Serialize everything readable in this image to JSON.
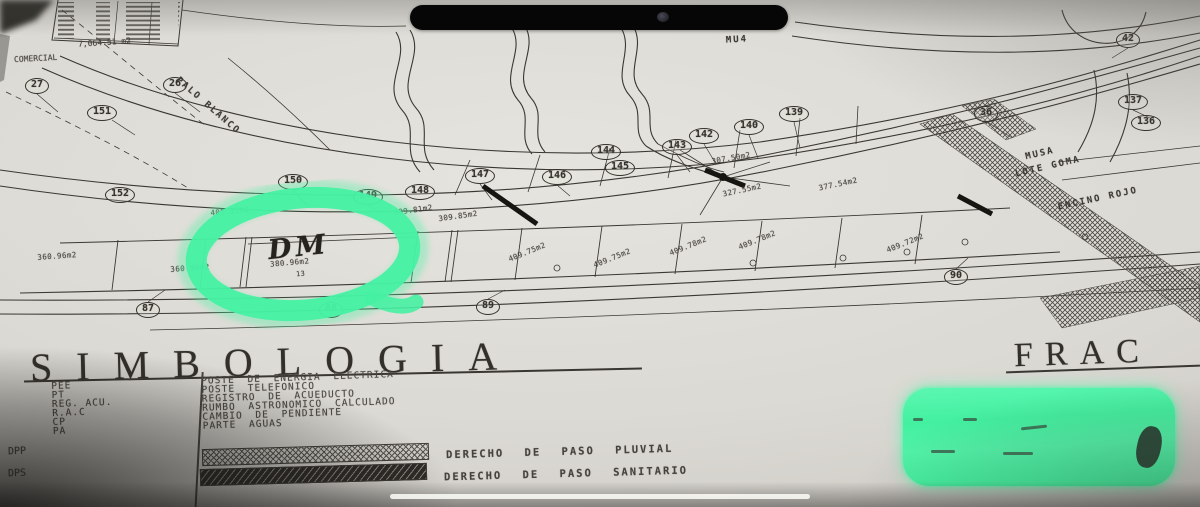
{
  "colors": {
    "highlight_green": "#46F1A3",
    "paper": "#D8D6D0",
    "ink": "#3B3833"
  },
  "plan": {
    "table": {
      "total": "7,064.51 m2",
      "caption": "COMERCIAL"
    },
    "highlight": {
      "handwritten_mark": "DM",
      "lot_area": "380.96m2",
      "lot_number": "13"
    },
    "lot_badges": [
      {
        "label": "27",
        "x": 37,
        "y": 86
      },
      {
        "label": "26",
        "x": 175,
        "y": 85
      },
      {
        "label": "151",
        "x": 102,
        "y": 113
      },
      {
        "label": "152",
        "x": 120,
        "y": 195
      },
      {
        "label": "150",
        "x": 293,
        "y": 182
      },
      {
        "label": "149",
        "x": 368,
        "y": 197
      },
      {
        "label": "148",
        "x": 420,
        "y": 192
      },
      {
        "label": "147",
        "x": 480,
        "y": 176
      },
      {
        "label": "146",
        "x": 557,
        "y": 177
      },
      {
        "label": "145",
        "x": 620,
        "y": 168
      },
      {
        "label": "144",
        "x": 606,
        "y": 152
      },
      {
        "label": "143",
        "x": 677,
        "y": 147
      },
      {
        "label": "142",
        "x": 704,
        "y": 136
      },
      {
        "label": "140",
        "x": 749,
        "y": 127
      },
      {
        "label": "139",
        "x": 794,
        "y": 114
      },
      {
        "label": "42",
        "x": 1128,
        "y": 40
      },
      {
        "label": "137",
        "x": 1133,
        "y": 102
      },
      {
        "label": "136",
        "x": 1146,
        "y": 123
      },
      {
        "label": "36",
        "x": 986,
        "y": 114
      },
      {
        "label": "87",
        "x": 148,
        "y": 310
      },
      {
        "label": "88",
        "x": 331,
        "y": 310
      },
      {
        "label": "89",
        "x": 488,
        "y": 307
      },
      {
        "label": "90",
        "x": 956,
        "y": 277
      }
    ],
    "area_labels": [
      {
        "label": "405.31m2",
        "x": 230,
        "y": 211,
        "rot": -6
      },
      {
        "label": "309.81m2",
        "x": 413,
        "y": 210,
        "rot": -8
      },
      {
        "label": "309.85m2",
        "x": 458,
        "y": 216,
        "rot": -8
      },
      {
        "label": "307.50m2",
        "x": 731,
        "y": 158,
        "rot": -10
      },
      {
        "label": "327.55m2",
        "x": 742,
        "y": 190,
        "rot": -12
      },
      {
        "label": "377.54m2",
        "x": 838,
        "y": 184,
        "rot": -12
      },
      {
        "label": "360.96m2",
        "x": 57,
        "y": 256,
        "rot": -4
      },
      {
        "label": "360.96m2",
        "x": 190,
        "y": 268,
        "rot": -4
      },
      {
        "label": "409.75m2",
        "x": 527,
        "y": 252,
        "rot": -22
      },
      {
        "label": "409.75m2",
        "x": 612,
        "y": 258,
        "rot": -22
      },
      {
        "label": "409.78m2",
        "x": 688,
        "y": 246,
        "rot": -22
      },
      {
        "label": "409.78m2",
        "x": 757,
        "y": 240,
        "rot": -22
      },
      {
        "label": "409.72m2",
        "x": 905,
        "y": 243,
        "rot": -22
      }
    ],
    "street_labels": [
      {
        "label": "PALO BLANCO",
        "x": 208,
        "y": 106,
        "rot": 41
      },
      {
        "label": "ENCINO ROJO",
        "x": 1098,
        "y": 199,
        "rot": -12
      },
      {
        "label": "MU4",
        "x": 737,
        "y": 40,
        "rot": -3
      },
      {
        "label": "MUSA",
        "x": 1040,
        "y": 154,
        "rot": -13
      },
      {
        "label": "LOTE GOMA",
        "x": 1048,
        "y": 167,
        "rot": -13
      }
    ]
  },
  "legend": {
    "title": "SIMBOLOGIA",
    "items": [
      {
        "abbr": "PEE",
        "desc": "POSTE DE ENERGIA ELECTRICA"
      },
      {
        "abbr": "PT",
        "desc": "POSTE TELEFONICO"
      },
      {
        "abbr": "REG. ACU.",
        "desc": "REGISTRO DE ACUEDUCTO"
      },
      {
        "abbr": "R.A.C",
        "desc": "RUMBO ASTRONOMICO CALCULADO"
      },
      {
        "abbr": "CP",
        "desc": "CAMBIO DE PENDIENTE"
      },
      {
        "abbr": "PA",
        "desc": "PARTE AGUAS"
      }
    ],
    "hatch_items": [
      {
        "abbr": "DPP",
        "desc": "DERECHO DE PASO PLUVIAL",
        "pattern": "crosshatch"
      },
      {
        "abbr": "DPS",
        "desc": "DERECHO DE PASO SANITARIO",
        "pattern": "diagonal-dark"
      }
    ]
  },
  "frame_title_partial": "FRAC"
}
